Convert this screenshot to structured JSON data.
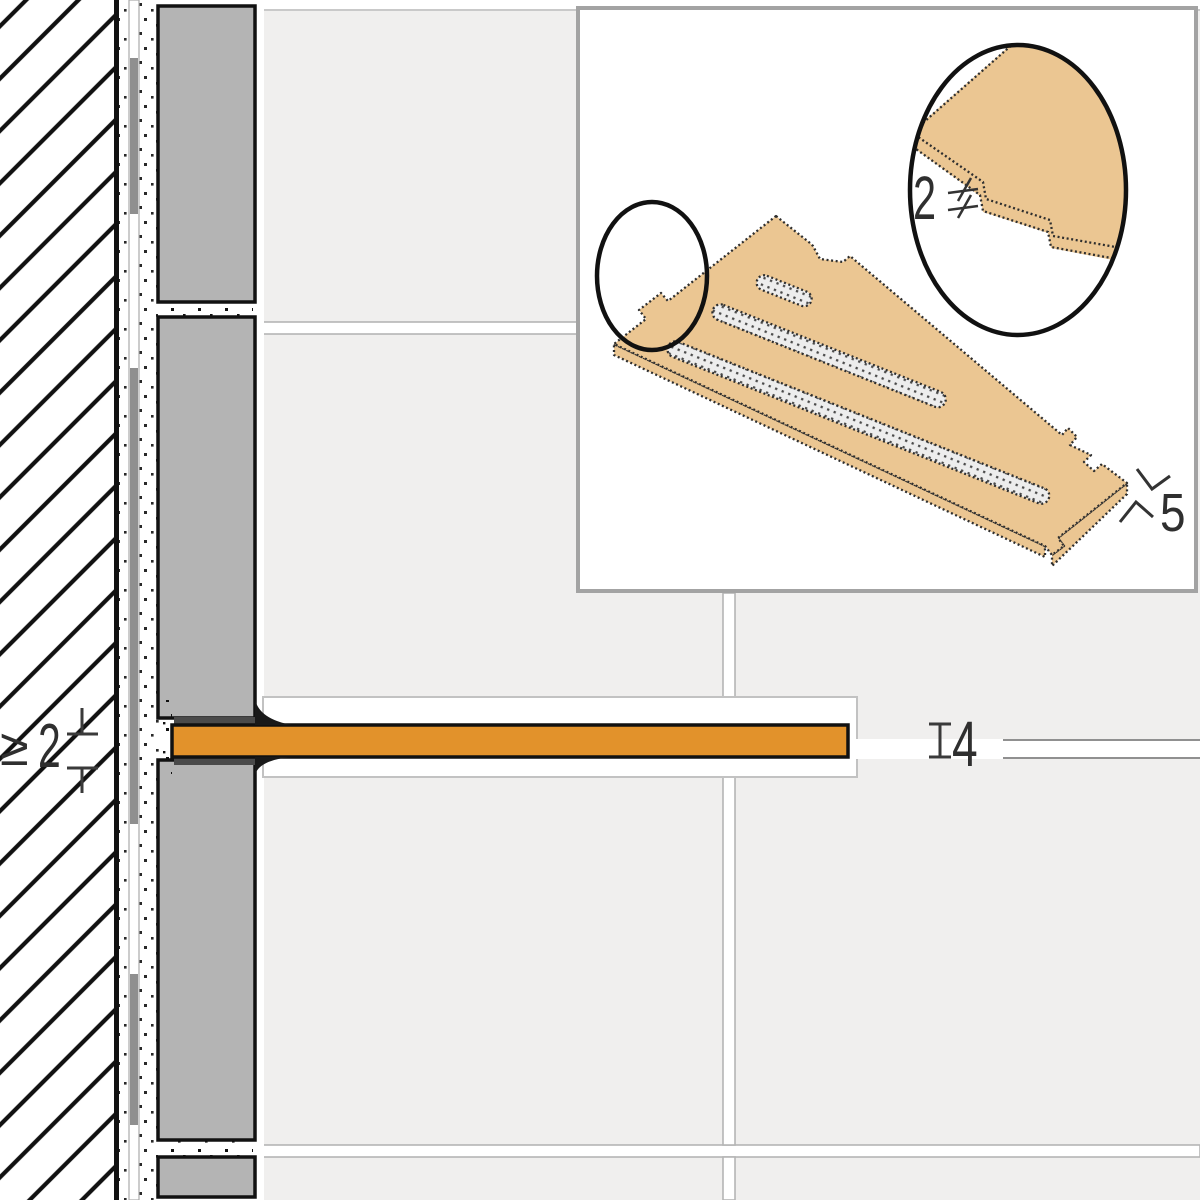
{
  "diagram": {
    "kind": "tile shelf installation cross-section with isometric detail inset",
    "labels": {
      "min_embed_prefix": "≥",
      "min_embed_value": "2",
      "joint_height_value": "4",
      "shelf_thickness_value": "5",
      "tab_detail_value": "2"
    },
    "colors": {
      "shelf_section_fill": "#E2922B",
      "shelf_iso_fill": "#EBC692",
      "tile_section_fill": "#B4B4B4",
      "tile_elevation_fill": "#F0EFEE",
      "grout_line": "#B5B5B5",
      "panel_border": "#A3A3A3",
      "outline_ink": "#111111"
    }
  }
}
